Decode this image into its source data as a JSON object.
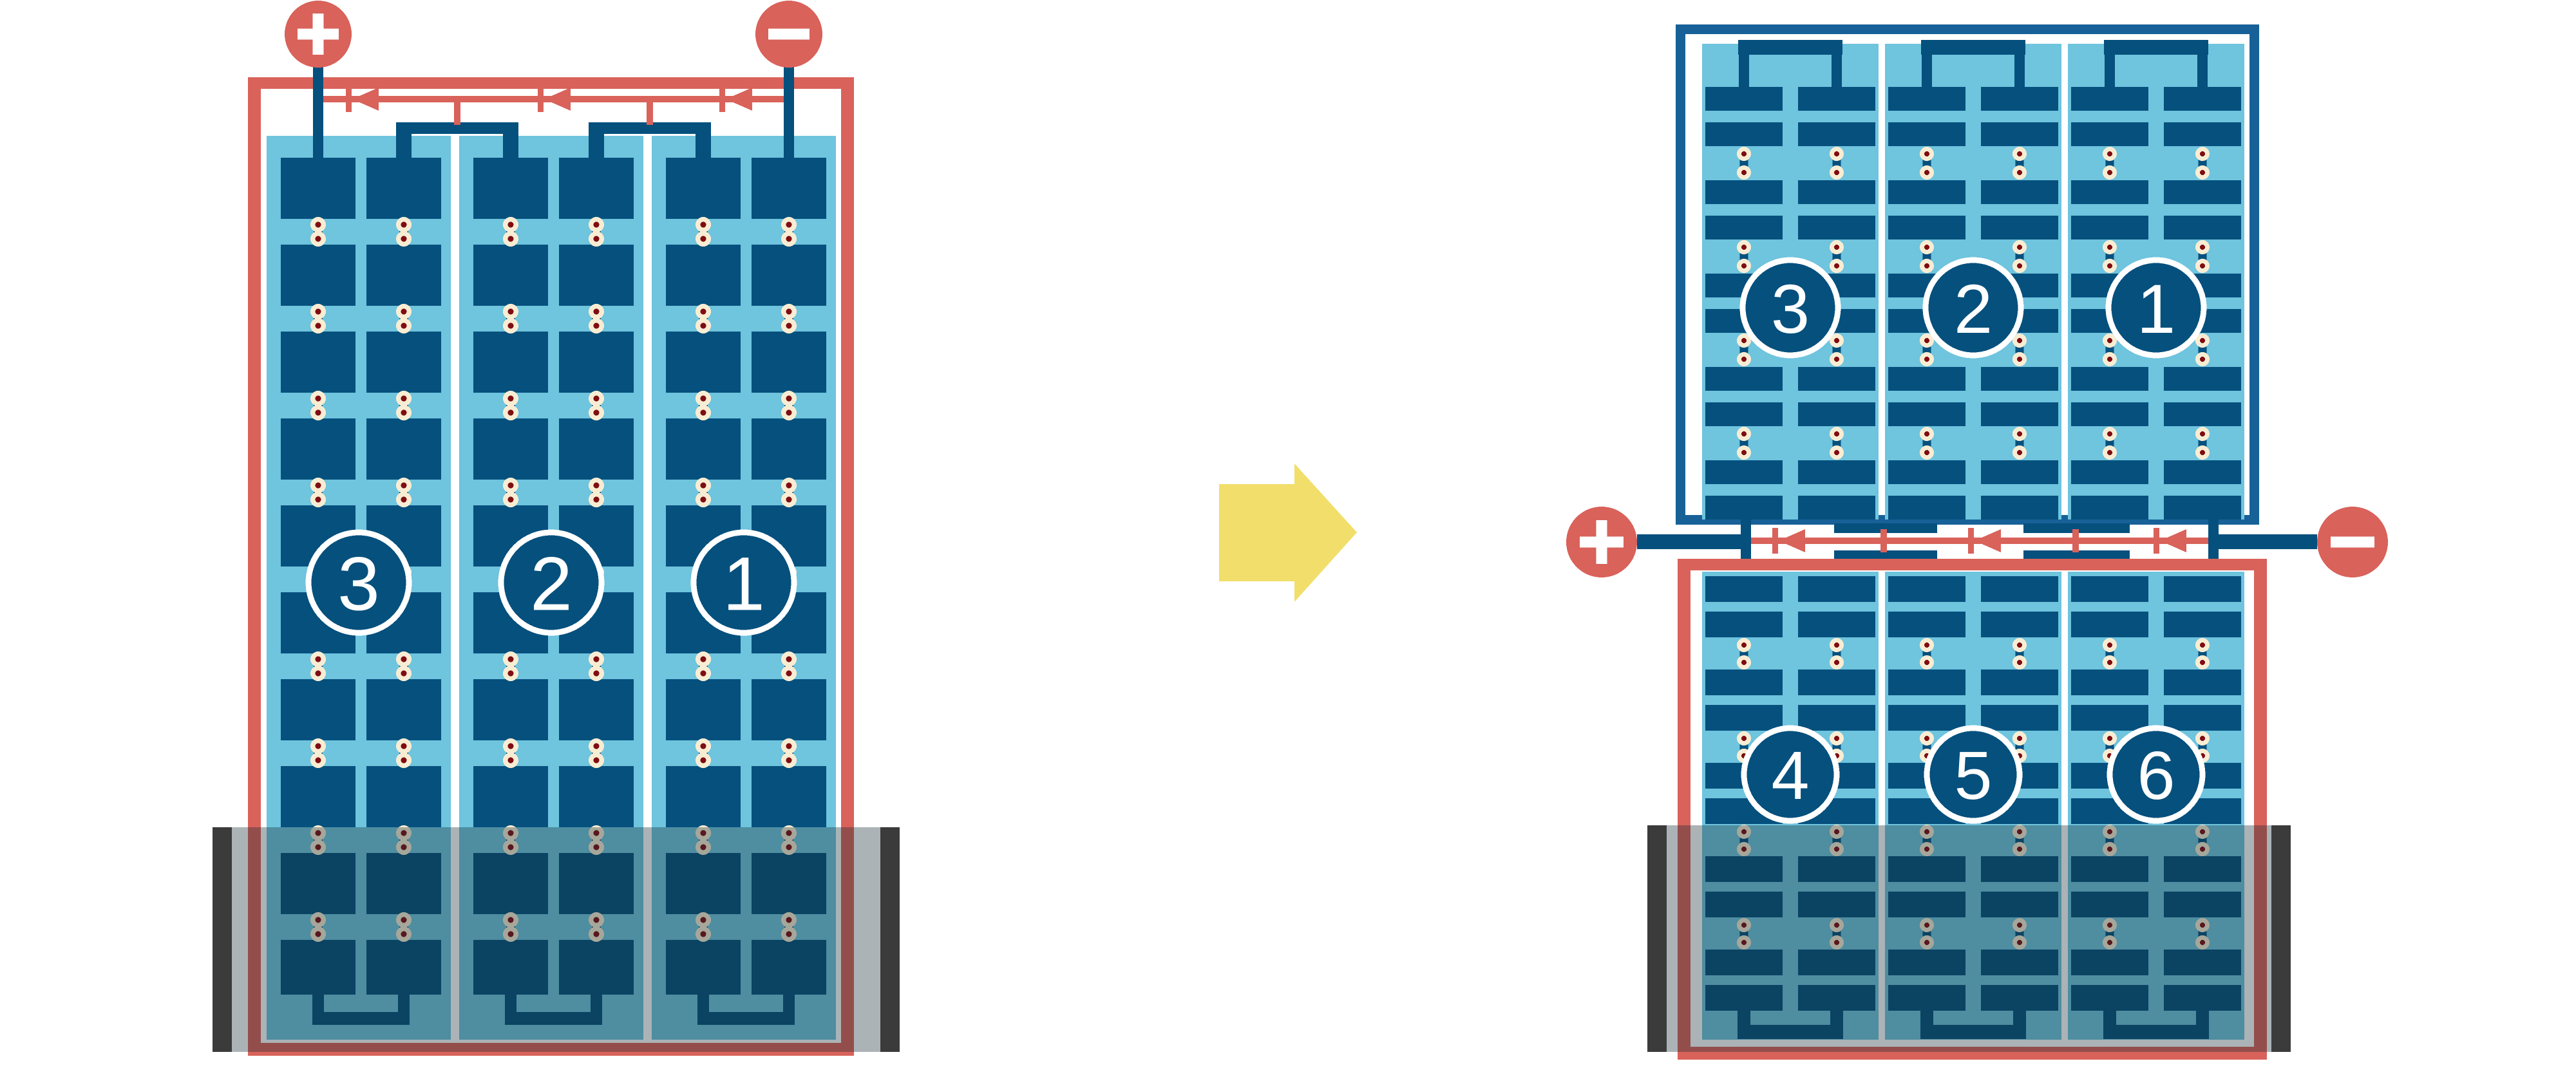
{
  "figure": {
    "description": "Solar module wiring comparison: full-cell module versus half-cut-cell module with bottom of both modules shaded",
    "colors": {
      "background": "#FFFFFF",
      "red": "#D9625A",
      "cell_blue": "#05507D",
      "panel_light_blue": "#6FC4DE",
      "frame_blue": "#176198",
      "solder_cream": "#F8EDD3",
      "solder_dark_red": "#7F0D12",
      "arrow_yellow": "#F2DE6B",
      "rail_dark": "#3B3B3B",
      "shade_overlay": "rgba(22,44,54,0.36)",
      "white": "#FFFFFF"
    },
    "left_module": {
      "terminals": [
        {
          "polarity": "+"
        },
        {
          "polarity": "−"
        }
      ],
      "strings": [
        {
          "label": "3"
        },
        {
          "label": "2"
        },
        {
          "label": "1"
        }
      ],
      "bypass_diode_count": 3,
      "shaded_bottom": true
    },
    "arrow": {
      "direction": "right"
    },
    "right_module": {
      "terminals": [
        {
          "polarity": "+"
        },
        {
          "polarity": "−"
        }
      ],
      "top_half": {
        "strings": [
          {
            "label": "3"
          },
          {
            "label": "2"
          },
          {
            "label": "1"
          }
        ]
      },
      "bottom_half": {
        "strings": [
          {
            "label": "4"
          },
          {
            "label": "5"
          },
          {
            "label": "6"
          }
        ]
      },
      "bypass_diode_count": 3,
      "shaded_bottom": true
    }
  }
}
